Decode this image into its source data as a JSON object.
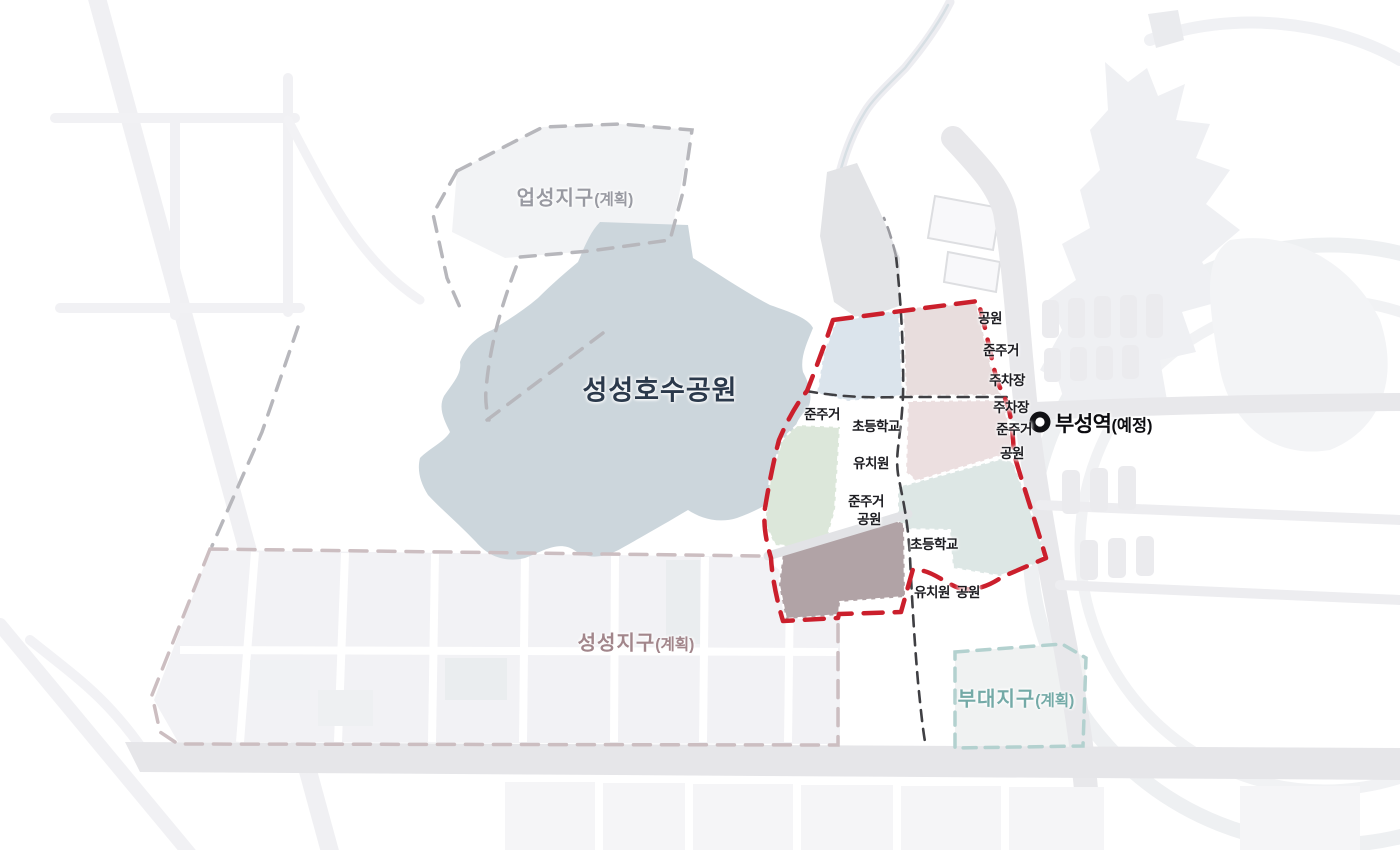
{
  "map": {
    "title_context": "urban district planning map",
    "districts": {
      "upseong": {
        "name": "업성지구",
        "suffix": "(계획)"
      },
      "lake_park": {
        "name": "성성호수공원"
      },
      "seongseong": {
        "name": "성성지구",
        "suffix": "(계획)"
      },
      "budae": {
        "name": "부대지구",
        "suffix": "(계획)"
      }
    },
    "station": {
      "name": "부성역",
      "suffix": "(예정)"
    },
    "labels": [
      {
        "id": "park-ne",
        "text": "공원"
      },
      {
        "id": "semi-res-ne",
        "text": "준주거"
      },
      {
        "id": "parking-1",
        "text": "주차장"
      },
      {
        "id": "parking-2",
        "text": "주차장"
      },
      {
        "id": "semi-res-e",
        "text": "준주거"
      },
      {
        "id": "park-e",
        "text": "공원"
      },
      {
        "id": "semi-res-w",
        "text": "준주거"
      },
      {
        "id": "elementary-school-1",
        "text": "초등학교"
      },
      {
        "id": "kindergarten-1",
        "text": "유치원"
      },
      {
        "id": "semi-res-sw",
        "text": "준주거"
      },
      {
        "id": "park-sw",
        "text": "공원"
      },
      {
        "id": "elementary-school-2",
        "text": "초등학교"
      },
      {
        "id": "kindergarten-2",
        "text": "유치원"
      },
      {
        "id": "park-s",
        "text": "공원"
      }
    ],
    "colors": {
      "boundary_red": "#cb1f2c",
      "road_dash_dark": "#3f3f43",
      "upseong_dash": "#b7b7bc",
      "seongseong_dash": "#ccbec1",
      "budae_dash": "#b3d1cf",
      "lake": "#ccd6dc",
      "zone_blue": "#dbe4ec",
      "zone_rose": "#e8dddd",
      "zone_pink": "#ecdfe0",
      "zone_green": "#dce7da",
      "zone_brown": "#b1a3a6",
      "zone_teal": "#dde7e5",
      "station_marker": "#101014"
    }
  }
}
